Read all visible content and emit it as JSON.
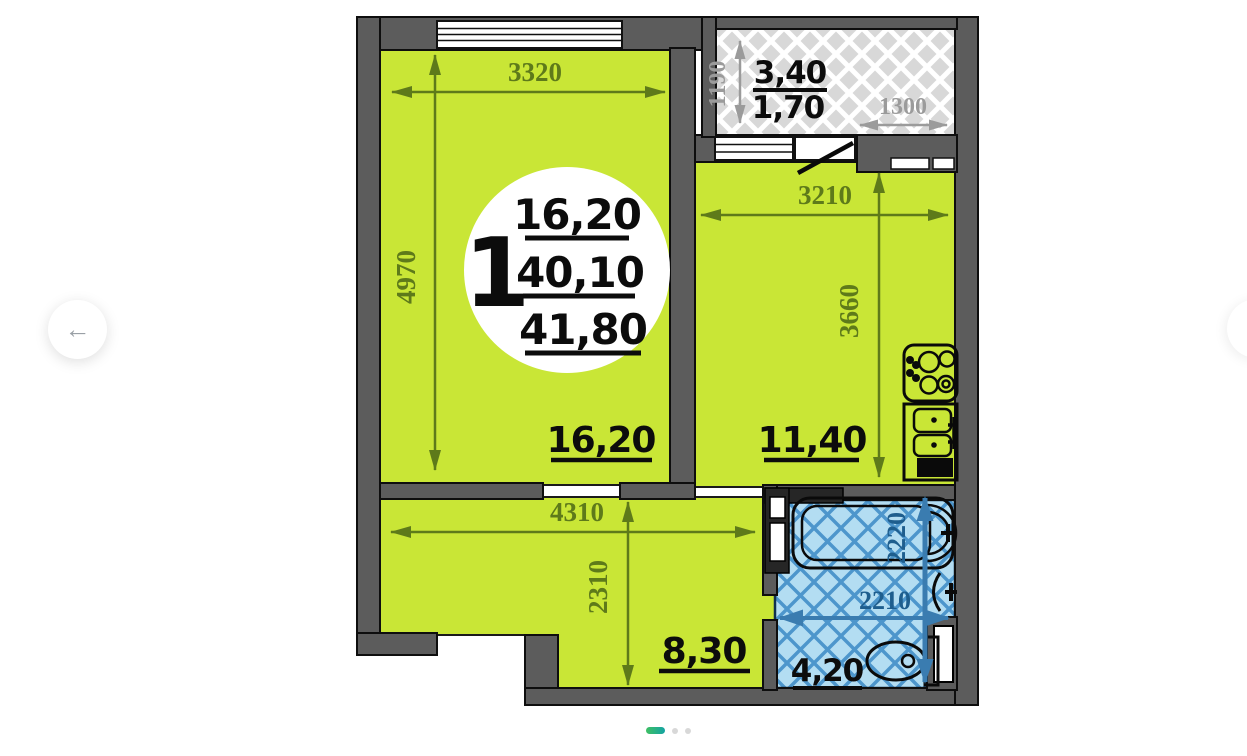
{
  "nav": {
    "prev_icon": "←"
  },
  "floorplan": {
    "info": {
      "rooms": "1",
      "living_area": "16,20",
      "area": "40,10",
      "total_area": "41,80"
    },
    "living_room": {
      "area": "16,20",
      "width_mm": "3320",
      "height_mm": "4970"
    },
    "kitchen": {
      "area": "11,40",
      "width_mm": "3210",
      "height_mm": "3660"
    },
    "hallway": {
      "area": "8,30",
      "width_mm": "4310",
      "height_mm": "2310"
    },
    "bathroom": {
      "area": "4,20",
      "width_mm": "2210",
      "height_mm": "2220"
    },
    "balcony": {
      "area": "3,40",
      "area_reduced": "1,70",
      "width_mm": "1300",
      "height_mm": "1190"
    }
  },
  "colors": {
    "floor_fill": "#c9e636",
    "wall": "#5c5c5c",
    "bathroom_fill": "#b3ddf2",
    "bathroom_lines": "#4d96cc",
    "dimension_text": "#5e7a1a",
    "bathroom_dimension_text": "#1e5e8e",
    "balcony_dimension_text": "#9b9b9b",
    "carousel_active_from": "#3fbf63",
    "carousel_active_to": "#14a3a3"
  }
}
